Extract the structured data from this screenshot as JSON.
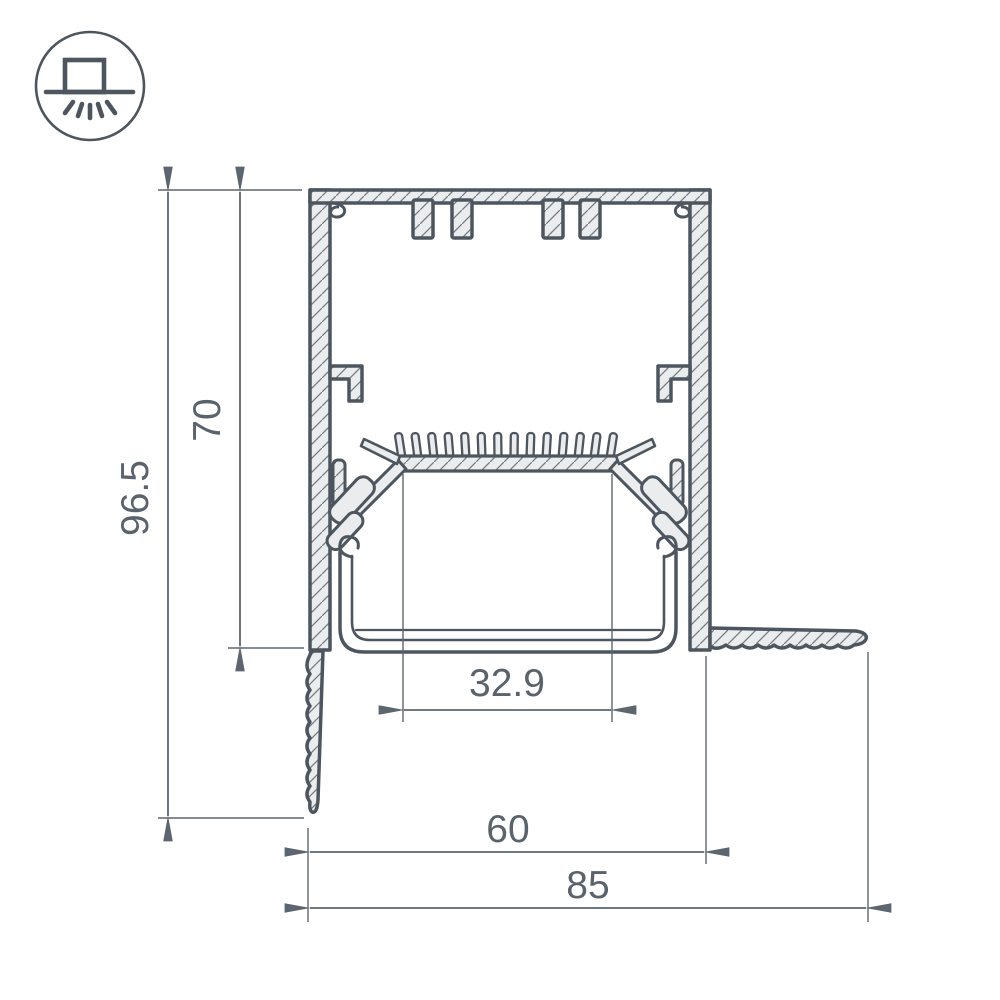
{
  "page": {
    "background": "#ffffff"
  },
  "badge": {
    "icon": "surface-mounted-light-icon"
  },
  "drawing": {
    "kind": "led-profile-cross-section-dimension-drawing",
    "dimensions": {
      "overall_height": "96.5",
      "body_height": "70",
      "led_window_width": "32.9",
      "body_width": "60",
      "overall_width": "85"
    },
    "colors": {
      "outline": "#4d565e",
      "material_fill": "#eaeced",
      "hatch": "#747d84",
      "dimension_lines": "#5d666e",
      "dimension_text": "#5a636b"
    }
  }
}
